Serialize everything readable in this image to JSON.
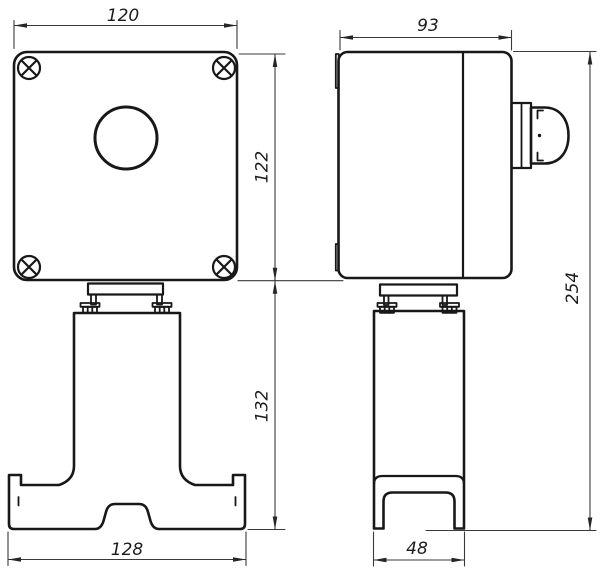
{
  "drawing": {
    "kind": "technical-drawing-two-views",
    "background_color": "#ffffff",
    "line_color": "#181818",
    "dimension_color": "#3a3a3a",
    "views": {
      "front": {
        "name": "front view - push button box on pedestal",
        "features": [
          "rounded enclosure",
          "4 corner screws",
          "round button hole",
          "mounting flange with bolts",
          "pedestal column",
          "base with arch cutout"
        ]
      },
      "side": {
        "name": "side view - enclosure with lid seam, hinges and side button, pedestal leg",
        "features": [
          "lid seam line",
          "hinge tabs",
          "protruding dome button",
          "mounting flange with bolts",
          "column with U-shaped foot"
        ]
      }
    },
    "dimensions": {
      "front_width": "120",
      "front_box_height": "122",
      "front_stand_height": "132",
      "front_base_width": "128",
      "side_depth": "93",
      "side_total_height": "254",
      "side_foot_width": "48"
    }
  }
}
